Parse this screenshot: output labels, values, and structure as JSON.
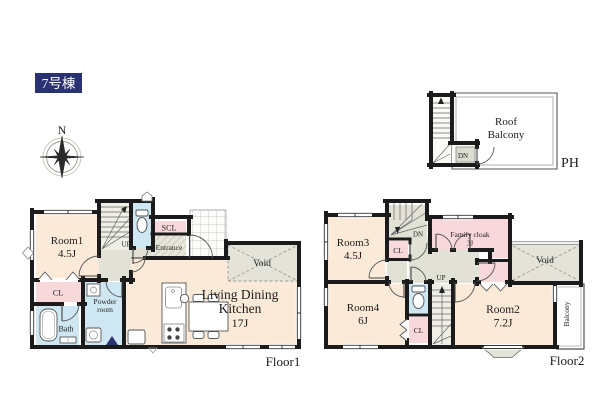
{
  "building": {
    "title": "7号棟"
  },
  "compass": {
    "north": "N"
  },
  "colors": {
    "room": "#fcead9",
    "closet": "#f9d8dc",
    "wet": "#cfe7f2",
    "hall": "#e2e1d5",
    "voidc": "#e4e3d9",
    "wall": "#1b1b1b",
    "navy": "#2b3272"
  },
  "floor1": {
    "label": "Floor1",
    "room1_name": "Room1",
    "room1_size": "4.5J",
    "closet": "CL",
    "bath": "Bath",
    "powder_line1": "Powder",
    "powder_line2": "room",
    "shoe_closet": "SCL",
    "entrance": "Entrance",
    "stairs_up": "UP",
    "ldk_line1": "Living Dining",
    "ldk_line2": "Kitchen",
    "ldk_size": "17J",
    "void": "Void"
  },
  "floor2": {
    "label": "Floor2",
    "room3_name": "Room3",
    "room3_size": "4.5J",
    "stairs_down": "DN",
    "hall_closet": "CL",
    "family_cloak_name": "Family cloak",
    "family_cloak_size": "3J",
    "stairs_up": "UP",
    "wc_closet": "CL",
    "room4_name": "Room4",
    "room4_size": "6J",
    "room2_name": "Room2",
    "room2_size": "7.2J",
    "void": "Void",
    "balcony": "Balcony"
  },
  "roof": {
    "label": "PH",
    "balcony_line1": "Roof",
    "balcony_line2": "Balcony",
    "stairs_down": "DN"
  }
}
